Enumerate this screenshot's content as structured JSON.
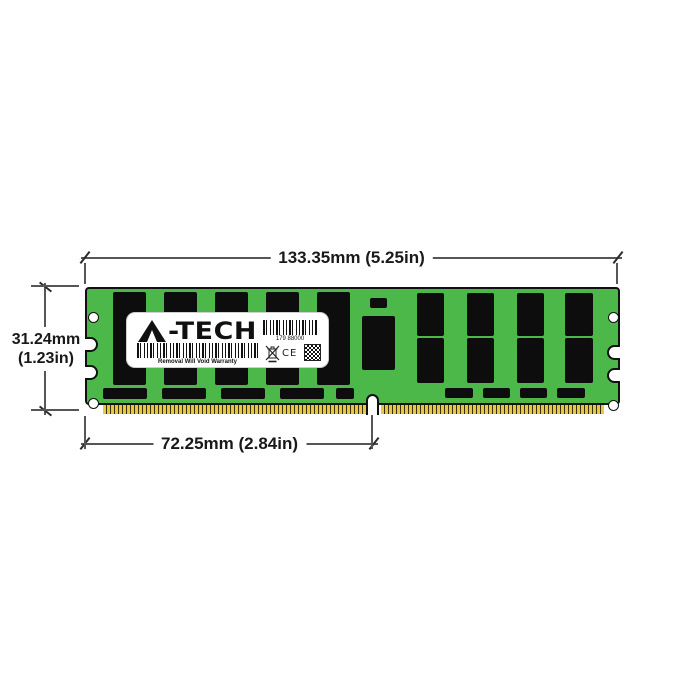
{
  "label": {
    "brand": "A-TECH",
    "brand_tail": "-TECH",
    "serial": "179 88000",
    "warranty": "Removal Will Void Warranty",
    "ce": "CE"
  },
  "dimensions": {
    "width_label": "133.35mm (5.25in)",
    "height_line1": "31.24mm",
    "height_line2": "(1.23in)",
    "pin_offset_label": "72.25mm (2.84in)"
  },
  "colors": {
    "pcb_green": "#4CB84A",
    "chip_black": "#0D0D0D",
    "pin_gold": "#E9C943",
    "pin_dark": "#3A2F08",
    "outline_black": "#101010",
    "dim_line": "#565656",
    "tick_dark": "#2B2B2B",
    "label_bg": "#FFFFFF"
  },
  "module": {
    "chips": [
      [
        28,
        5,
        33,
        93
      ],
      [
        79,
        5,
        33,
        93
      ],
      [
        130,
        5,
        33,
        93
      ],
      [
        181,
        5,
        33,
        93
      ],
      [
        232,
        5,
        33,
        93
      ],
      [
        18,
        101,
        44,
        11
      ],
      [
        77,
        101,
        44,
        11
      ],
      [
        136,
        101,
        44,
        11
      ],
      [
        195,
        101,
        44,
        11
      ],
      [
        251,
        101,
        18,
        11
      ],
      [
        285,
        11,
        17,
        10
      ],
      [
        277,
        29,
        33,
        54
      ],
      [
        332,
        6,
        27,
        43
      ],
      [
        382,
        6,
        27,
        43
      ],
      [
        432,
        6,
        27,
        43
      ],
      [
        480,
        6,
        28,
        43
      ],
      [
        332,
        51,
        27,
        45
      ],
      [
        382,
        51,
        27,
        45
      ],
      [
        432,
        51,
        27,
        45
      ],
      [
        480,
        51,
        28,
        45
      ],
      [
        360,
        101,
        28,
        10
      ],
      [
        398,
        101,
        27,
        10
      ],
      [
        435,
        101,
        27,
        10
      ],
      [
        472,
        101,
        28,
        10
      ]
    ],
    "holes": [
      [
        8,
        30
      ],
      [
        528,
        30
      ],
      [
        8,
        116
      ],
      [
        528,
        118
      ]
    ]
  }
}
